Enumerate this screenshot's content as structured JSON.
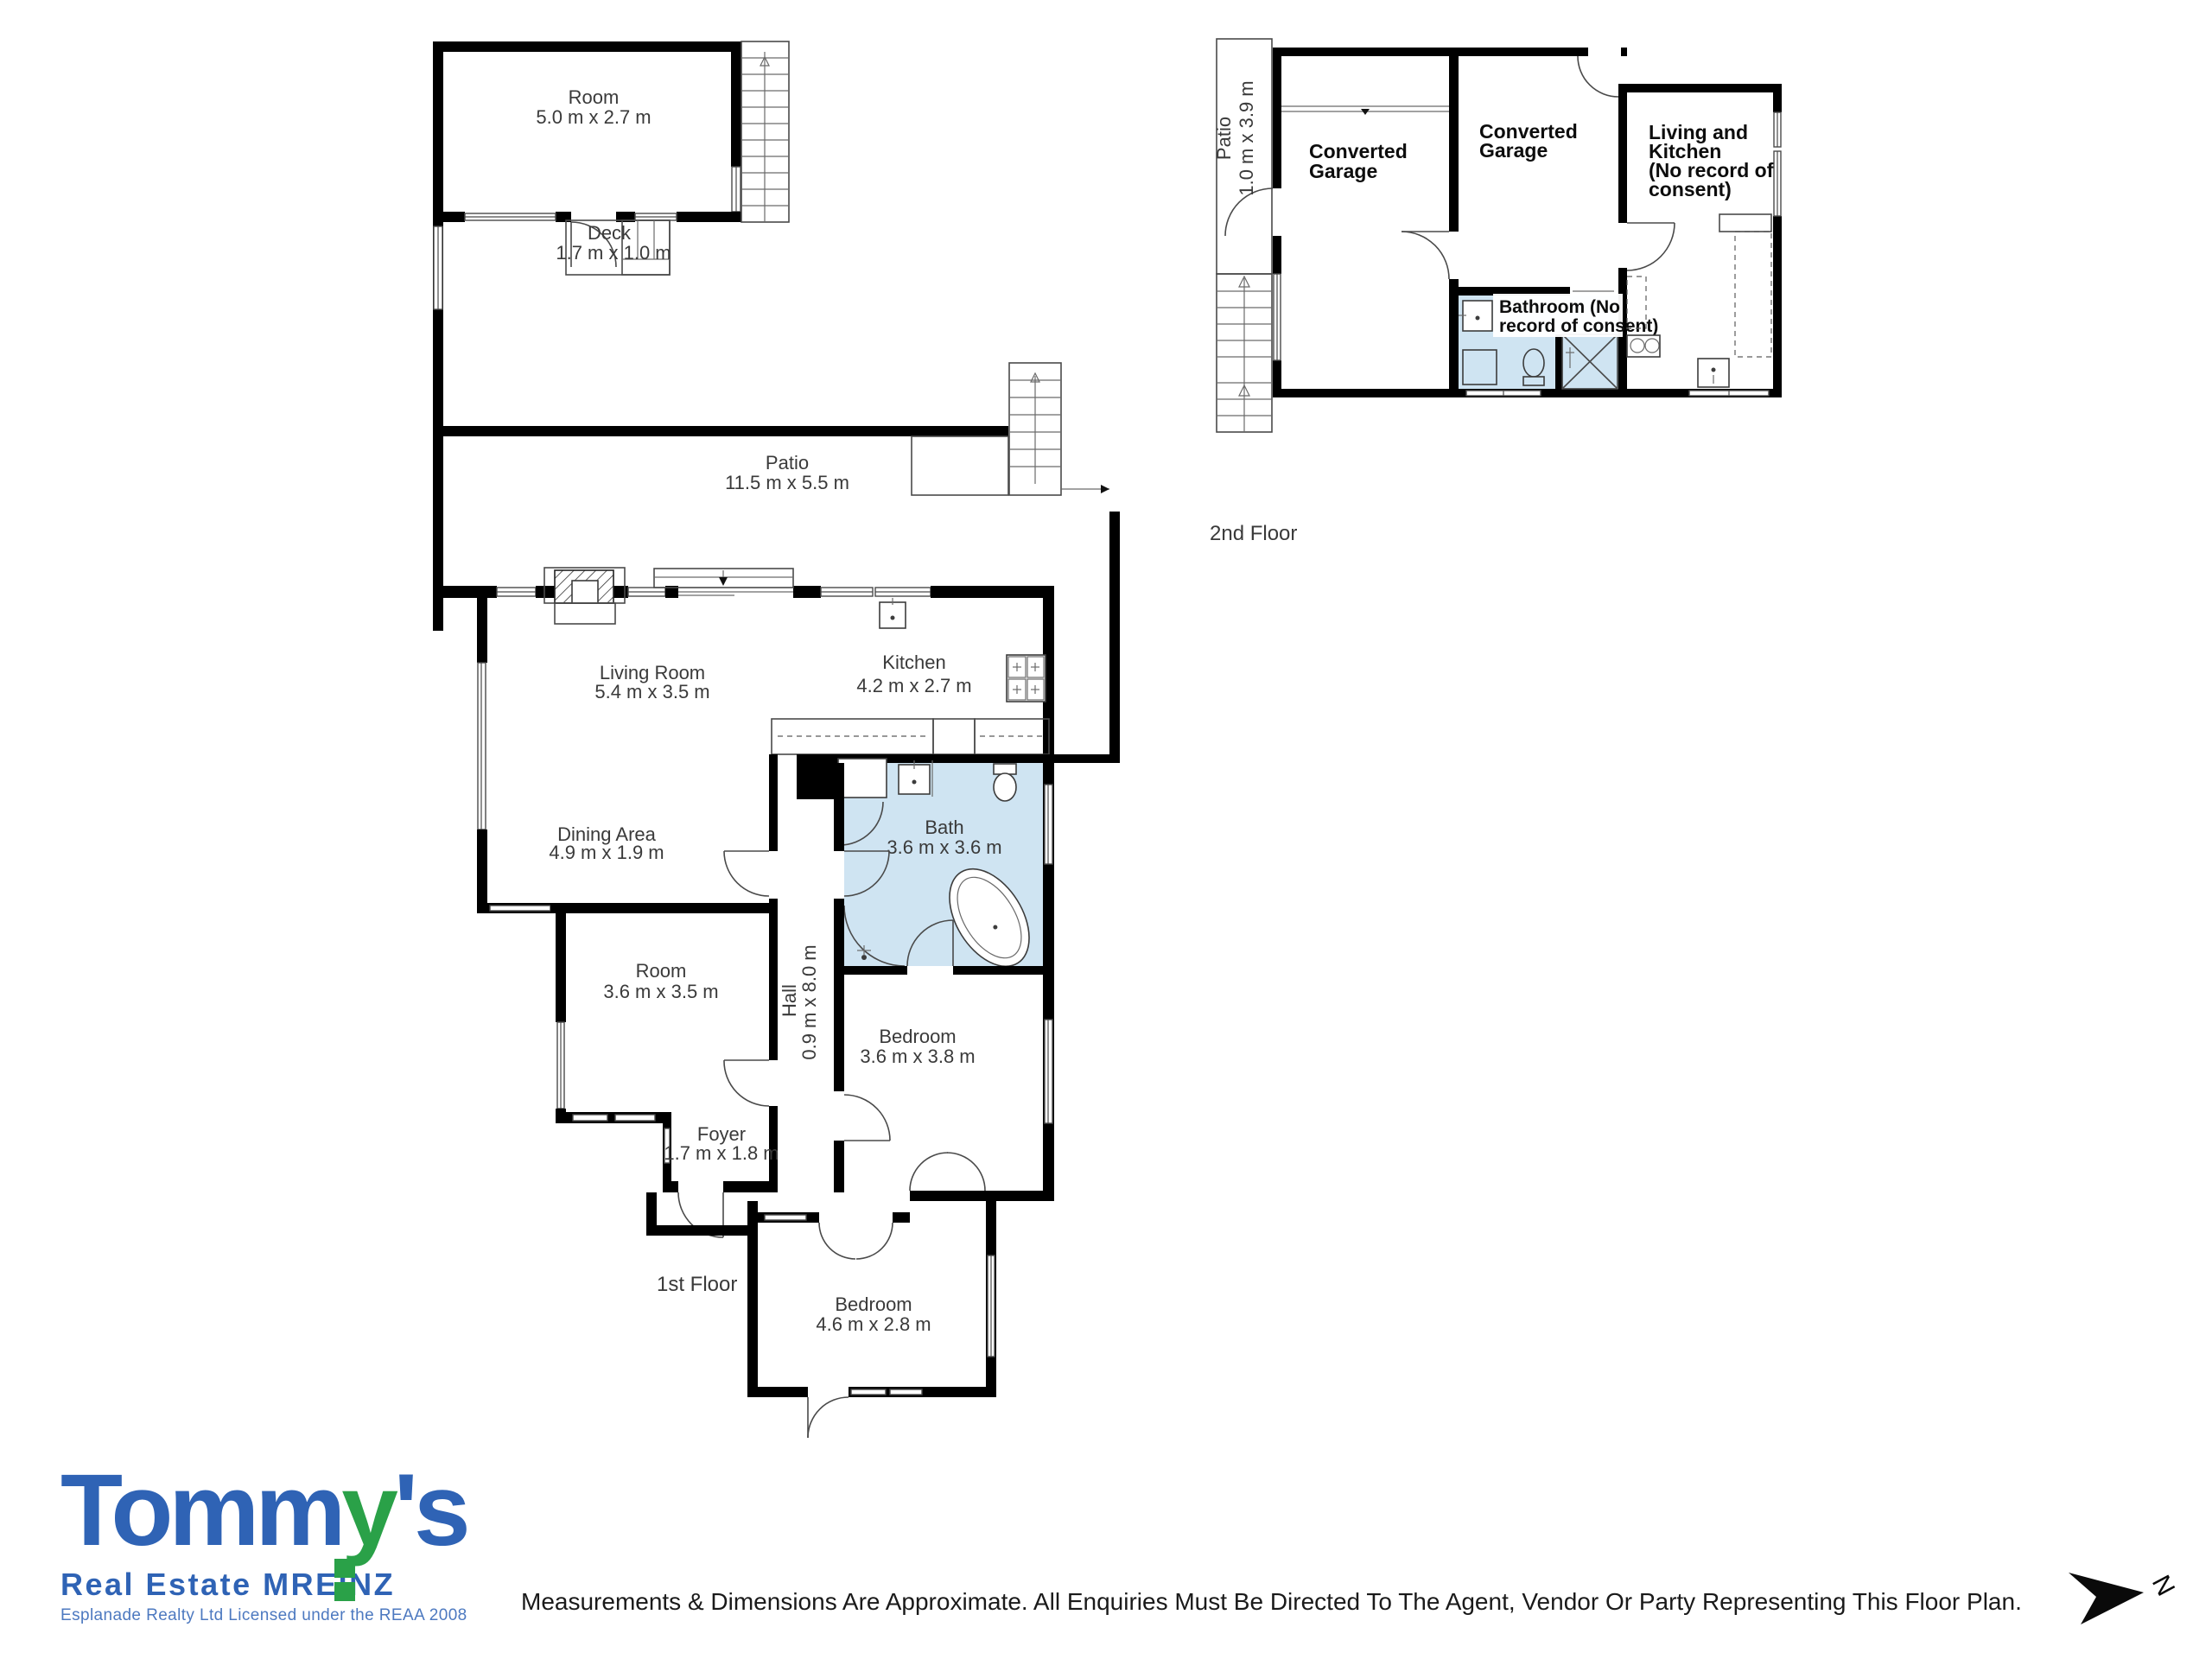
{
  "colors": {
    "wall": "#000000",
    "bath_fill": "#cfe4f2",
    "label_gray": "#3a3a3a",
    "logo_blue": "#2f63b5",
    "logo_green": "#2aa148",
    "logo_small_blue": "#4d79c0"
  },
  "floor1": {
    "label": "1st Floor",
    "rooms": {
      "room_top": {
        "name": "Room",
        "dims": "5.0 m x 2.7 m"
      },
      "deck": {
        "name": "Deck",
        "dims": "1.7 m x 1.0 m"
      },
      "patio": {
        "name": "Patio",
        "dims": "11.5 m x 5.5 m"
      },
      "living": {
        "name": "Living Room",
        "dims": "5.4 m x 3.5 m"
      },
      "kitchen": {
        "name": "Kitchen",
        "dims": "4.2 m x 2.7 m"
      },
      "dining": {
        "name": "Dining Area",
        "dims": "4.9 m x 1.9 m"
      },
      "bath": {
        "name": "Bath",
        "dims": "3.6 m x 3.6 m"
      },
      "room_mid": {
        "name": "Room",
        "dims": "3.6 m x 3.5 m"
      },
      "hall": {
        "name": "Hall",
        "dims": "0.9 m x 8.0 m"
      },
      "bedroom_mid": {
        "name": "Bedroom",
        "dims": "3.6 m x 3.8 m"
      },
      "foyer": {
        "name": "Foyer",
        "dims": "1.7 m x 1.8 m"
      },
      "bedroom_bottom": {
        "name": "Bedroom",
        "dims": "4.6 m x 2.8 m"
      }
    }
  },
  "floor2": {
    "label": "2nd Floor",
    "rooms": {
      "patio": {
        "name": "Patio",
        "dims": "1.0 m x 3.9 m"
      },
      "garage1": {
        "line1": "Converted",
        "line2": "Garage"
      },
      "garage2": {
        "line1": "Converted",
        "line2": "Garage"
      },
      "living_kitchen": {
        "line1": "Living and",
        "line2": "Kitchen",
        "line3": "(No record of",
        "line4": "consent)"
      },
      "bathroom": {
        "line1": "Bathroom (No",
        "line2": "record of consent)"
      }
    }
  },
  "branding": {
    "logo_part1": "Tomm",
    "logo_part2": "y",
    "logo_part3": "'s",
    "logo_sub": "Real Estate MREINZ",
    "logo_license": "Esplanade Realty Ltd Licensed under the REAA 2008"
  },
  "footer": {
    "disclaimer": "Measurements & Dimensions Are Approximate. All Enquiries Must Be Directed To The Agent, Vendor Or Party Representing This Floor Plan."
  },
  "compass": {
    "label": "N"
  }
}
